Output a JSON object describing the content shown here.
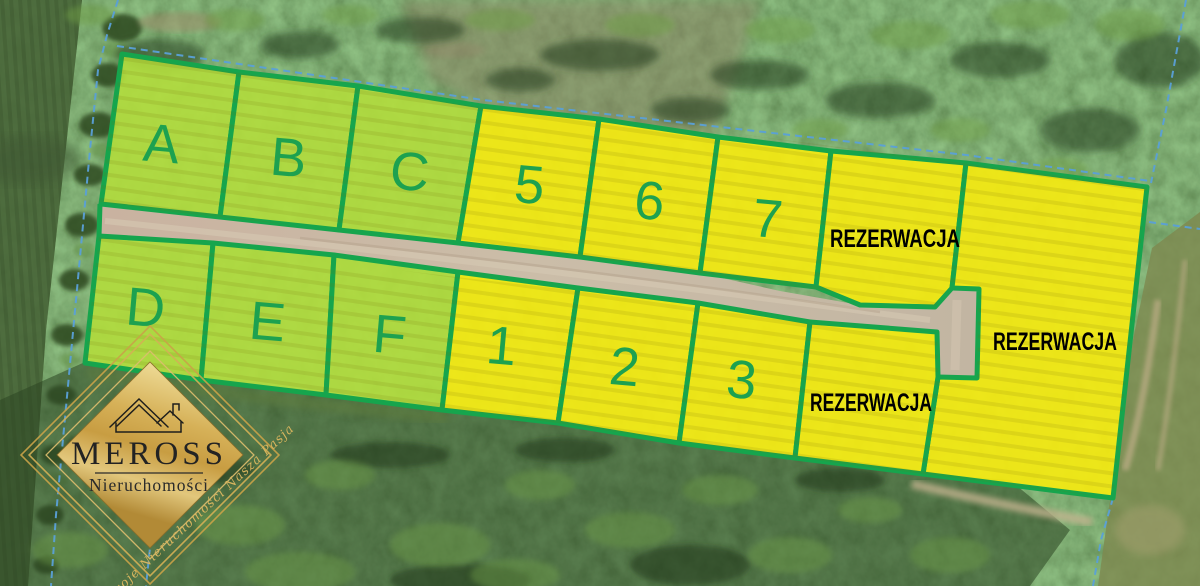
{
  "plots": {
    "items": [
      {
        "id": "A",
        "label": "A",
        "color": "lime"
      },
      {
        "id": "B",
        "label": "B",
        "color": "lime"
      },
      {
        "id": "C",
        "label": "C",
        "color": "lime"
      },
      {
        "id": "5",
        "label": "5",
        "color": "yellow"
      },
      {
        "id": "6",
        "label": "6",
        "color": "yellow"
      },
      {
        "id": "7",
        "label": "7",
        "color": "yellow"
      },
      {
        "id": "rez-top",
        "label": "REZERWACJA",
        "color": "yellow",
        "status": "reserved"
      },
      {
        "id": "rez-right",
        "label": "REZERWACJA",
        "color": "yellow",
        "status": "reserved"
      },
      {
        "id": "D",
        "label": "D",
        "color": "lime"
      },
      {
        "id": "E",
        "label": "E",
        "color": "lime"
      },
      {
        "id": "F",
        "label": "F",
        "color": "lime"
      },
      {
        "id": "1",
        "label": "1",
        "color": "yellow"
      },
      {
        "id": "2",
        "label": "2",
        "color": "yellow"
      },
      {
        "id": "3",
        "label": "3",
        "color": "yellow"
      },
      {
        "id": "rez-bottom",
        "label": "REZERWACJA",
        "color": "yellow",
        "status": "reserved"
      }
    ]
  },
  "colors": {
    "plot_border": "#16a54d",
    "lime_fill": "#b2dd3d",
    "yellow_fill": "#f4ea12",
    "plot_label_green": "#1da150",
    "reservation_text": "#000000",
    "road_tan": "#c7b6a2",
    "cadastral_blue": "#5aa0d8",
    "logo_gold": "#d4b268"
  },
  "branding": {
    "name": "MEROSS",
    "subtitle": "Nieruchomości",
    "slogan": "Twoje Nieruchomości Nasza Pasja"
  }
}
